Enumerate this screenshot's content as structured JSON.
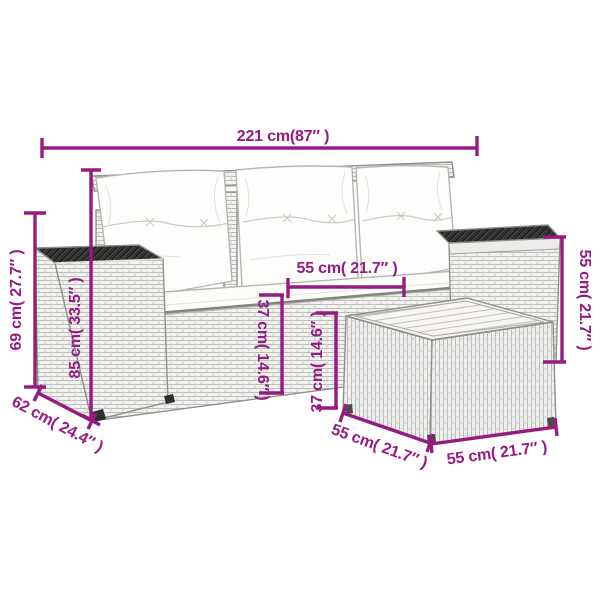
{
  "accent_color": "#951b81",
  "figure": {
    "type": "product-dimension-diagram",
    "subject": "poly-rattan garden sofa set with white cushions and side table"
  },
  "dimensions": {
    "overall_width": "221 cm(87″ )",
    "overall_height": "69 cm( 27.7″ )",
    "backrest_height": "85 cm( 33.5″ )",
    "armrest_depth": "62 cm( 24.4″ )",
    "seat_width": "55 cm( 21.7″ )",
    "seat_height": "37 cm( 14.6″ )",
    "table_height": "37 cm( 14.6″ )",
    "right_section_height": "55 cm( 21.7″ )",
    "table_depth": "55 cm( 21.7″ )",
    "table_width": "55 cm( 21.7″ )"
  }
}
